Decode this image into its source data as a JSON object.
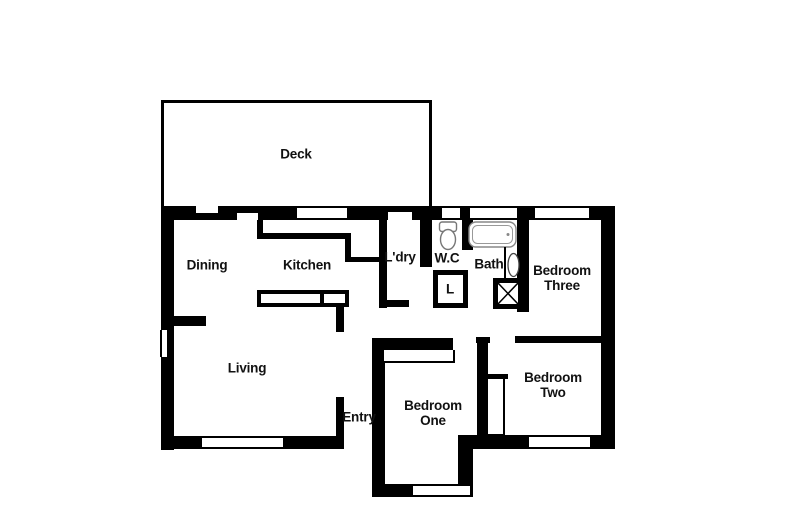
{
  "figure": {
    "type": "residential-floor-plan",
    "colors": {
      "wall": "#000000",
      "background": "#ffffff",
      "fixture_outline": "#808080",
      "text": "#111111"
    }
  },
  "rooms": {
    "deck": {
      "label": "Deck"
    },
    "dining": {
      "label": "Dining"
    },
    "kitchen": {
      "label": "Kitchen"
    },
    "laundry": {
      "label": "L'dry"
    },
    "wc": {
      "label": "W.C"
    },
    "bath": {
      "label": "Bath"
    },
    "linen_closet": {
      "label": "L"
    },
    "living": {
      "label": "Living"
    },
    "entry": {
      "label": "Entry"
    },
    "bedroom_one": {
      "label": "Bedroom\nOne"
    },
    "bedroom_two": {
      "label": "Bedroom\nTwo"
    },
    "bedroom_three": {
      "label": "Bedroom\nThree"
    }
  },
  "fixtures": [
    {
      "icon": "toilet-icon",
      "room": "W.C"
    },
    {
      "icon": "bathtub-icon",
      "room": "Bath"
    },
    {
      "icon": "basin-icon",
      "room": "Bath"
    },
    {
      "icon": "shower-icon",
      "room": "Bath"
    },
    {
      "icon": "kitchen-bench-icon",
      "room": "Kitchen"
    },
    {
      "icon": "wardrobe-icon",
      "room": "Bedroom One"
    },
    {
      "icon": "closet-icon",
      "room": "Bedroom Two"
    },
    {
      "icon": "linen-closet-icon",
      "room": "L"
    }
  ]
}
